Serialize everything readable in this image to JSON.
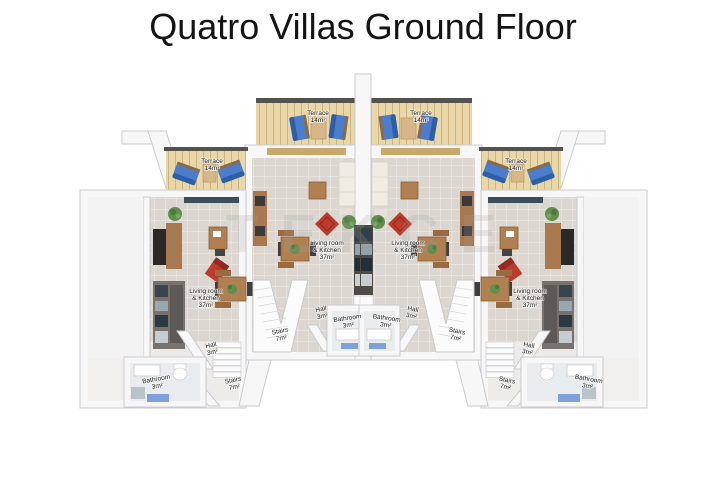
{
  "title": "Quatro Villas Ground Floor",
  "watermark": "TEKCE",
  "plan": {
    "type": "floor-plan",
    "floor": "Ground Floor",
    "villa_count": 4,
    "villas": [
      {
        "position": "far-left",
        "rooms": [
          "terrace",
          "living",
          "hall",
          "stairs",
          "bathroom"
        ]
      },
      {
        "position": "center-left",
        "rooms": [
          "terrace",
          "living",
          "hall",
          "stairs",
          "bathroom"
        ]
      },
      {
        "position": "center-right",
        "rooms": [
          "terrace",
          "living",
          "hall",
          "stairs",
          "bathroom"
        ]
      },
      {
        "position": "far-right",
        "rooms": [
          "terrace",
          "living",
          "hall",
          "stairs",
          "bathroom"
        ]
      }
    ]
  },
  "room_labels": {
    "terrace": {
      "name": "Terrace",
      "area": "14m²"
    },
    "living": {
      "line1": "Living room",
      "line2": "& Kitchen",
      "area": "37m²"
    },
    "hall": {
      "name": "Hall",
      "area": "3m²"
    },
    "bathroom": {
      "name": "Bathroom",
      "area": "3m²"
    },
    "stairs": {
      "name": "Stairs",
      "area": "7m²"
    }
  },
  "colors": {
    "terrace_wood": "#ead7a8",
    "lounge_chair_blue": "#4a7dcb",
    "lounge_chair_shadow": "#2f5ea8",
    "accent_red": "#bf3a2b",
    "floor_tile": "#dbd7d0",
    "wall_white": "#f7f7f8",
    "furniture_wood": "#b08050",
    "cabinet_wood": "#a8784e",
    "tv_black": "#2b2927",
    "plant_green": "#5f8f4a",
    "bath_mat_blue": "#6a93d6",
    "window_frame_tan": "#c9a96a",
    "roof_edge_dark": "#55524e"
  }
}
